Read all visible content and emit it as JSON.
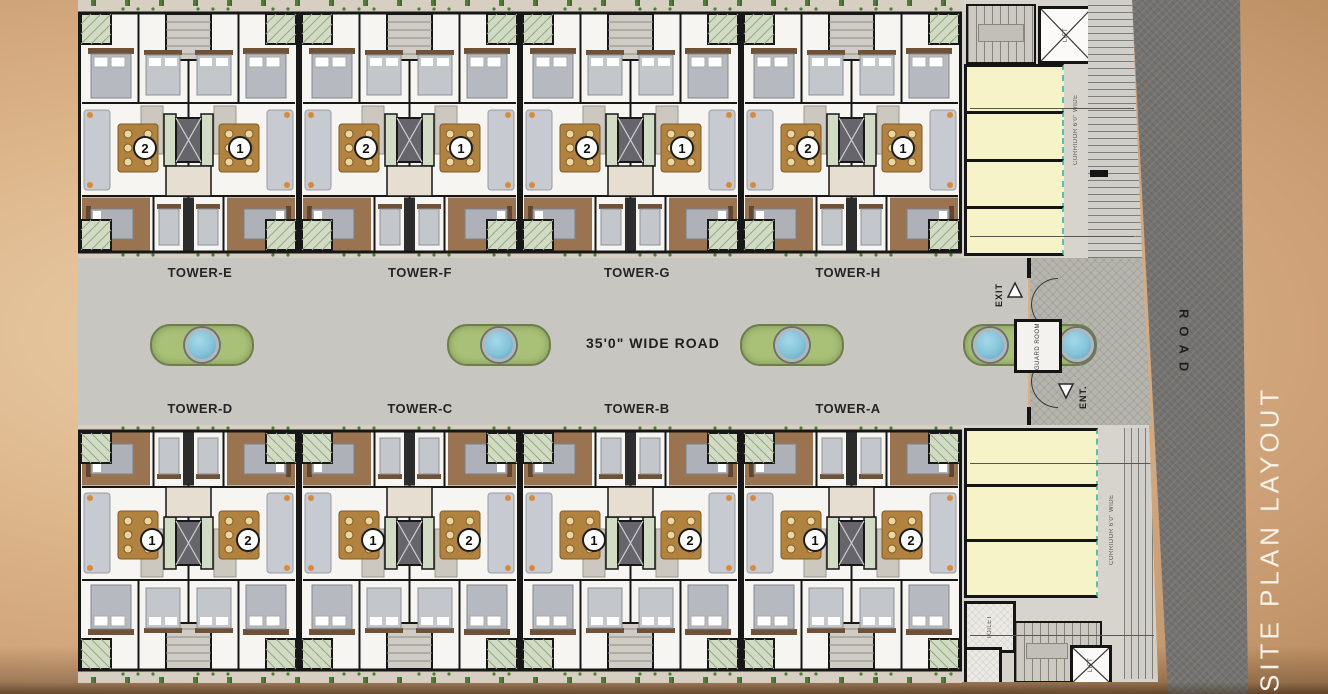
{
  "page": {
    "site_title": "SITE PLAN LAYOUT"
  },
  "labels": {
    "main_road": "ROAD",
    "central_road": "35'0\" WIDE ROAD",
    "exit": "EXIT",
    "entrance": "ENT.",
    "guard_room": "GUARD ROOM"
  },
  "towers_top": [
    {
      "label": "TOWER-E",
      "units": [
        "2",
        "1"
      ]
    },
    {
      "label": "TOWER-F",
      "units": [
        "2",
        "1"
      ]
    },
    {
      "label": "TOWER-G",
      "units": [
        "2",
        "1"
      ]
    },
    {
      "label": "TOWER-H",
      "units": [
        "2",
        "1"
      ]
    }
  ],
  "towers_bottom": [
    {
      "label": "TOWER-D",
      "units": [
        "1",
        "2"
      ]
    },
    {
      "label": "TOWER-C",
      "units": [
        "1",
        "2"
      ]
    },
    {
      "label": "TOWER-B",
      "units": [
        "1",
        "2"
      ]
    },
    {
      "label": "TOWER-A",
      "units": [
        "1",
        "2"
      ]
    }
  ],
  "parking_top": {
    "corridor": "CORRIDOR 6'0\" WIDE",
    "lift": "LIFT"
  },
  "parking_bottom": {
    "corridor": "CORRIDOR 6'0\" WIDE",
    "lift": "LIFT",
    "toilet": "TOILET"
  },
  "colors": {
    "background_tan": "#d2a87c",
    "road_gray": "#c7c6c0",
    "asphalt": "#747370",
    "island_green": "#a9c176",
    "water_blue": "#84c3d9",
    "parking_yellow": "#f7f3c8",
    "wood_brown": "#9a7351",
    "title_white": "#f8f2e8"
  }
}
